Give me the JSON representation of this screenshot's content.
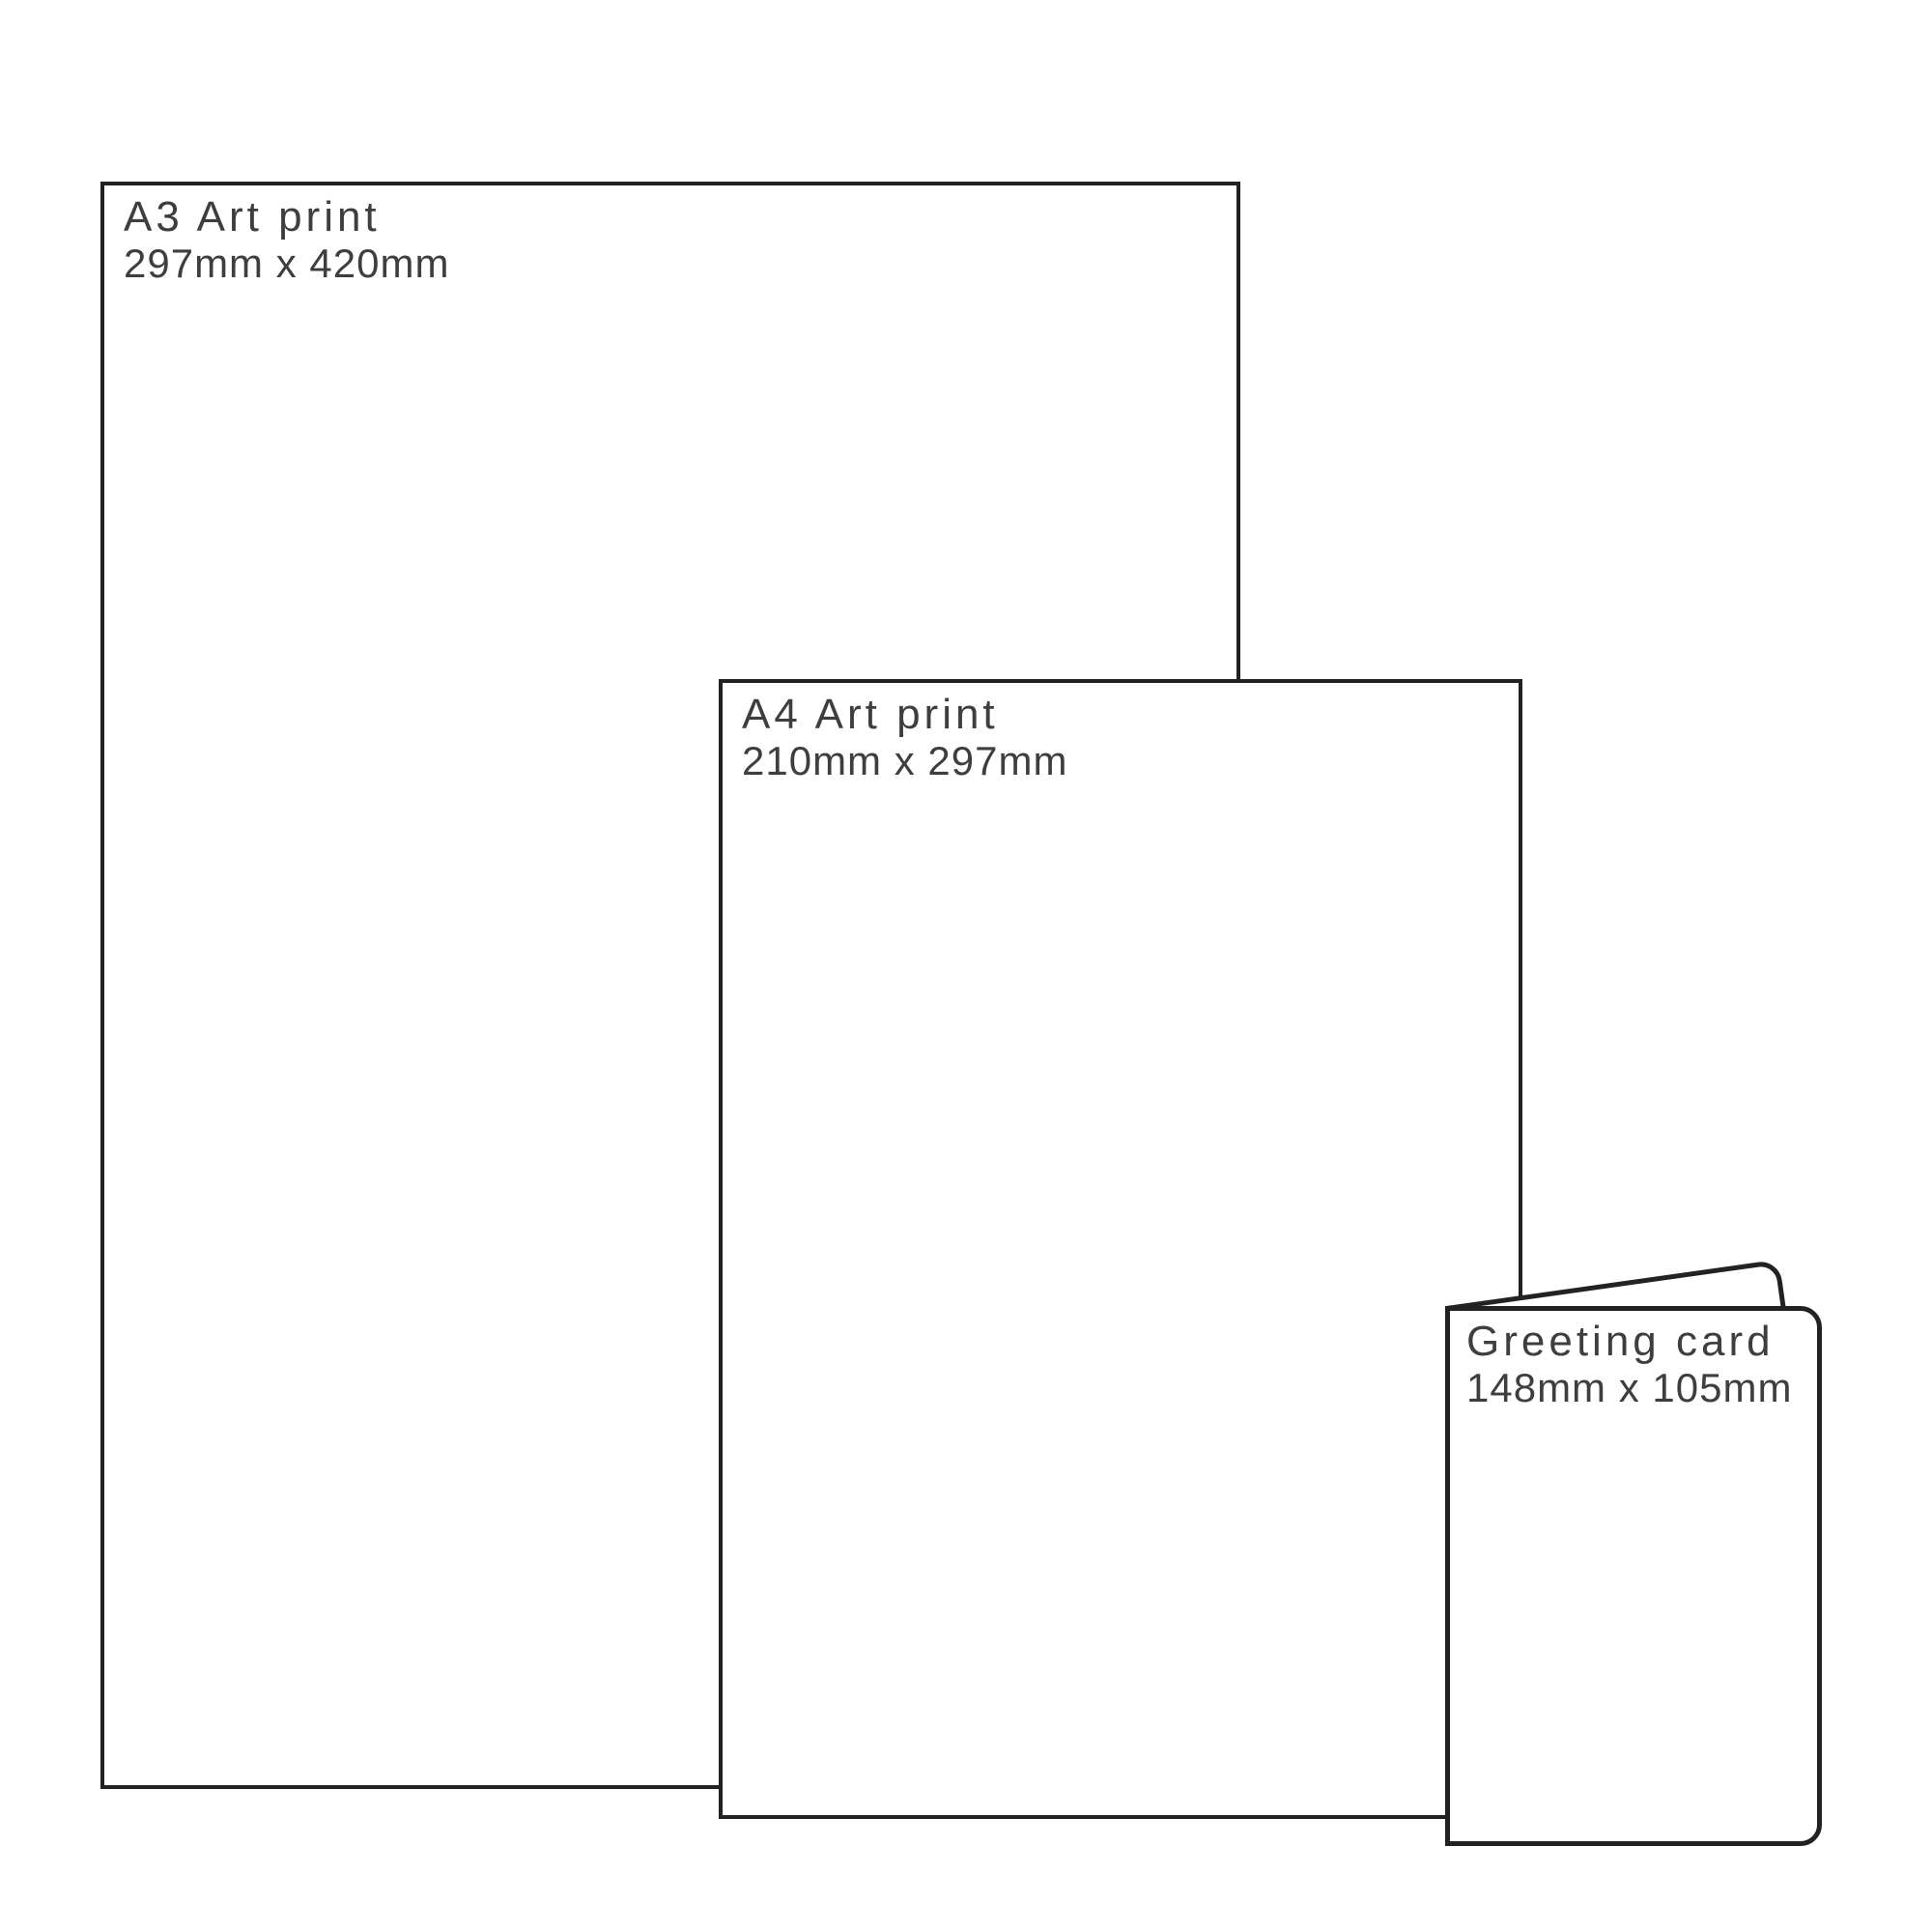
{
  "colors": {
    "background": "#ffffff",
    "outline": "#222222",
    "text": "#3e3e3e"
  },
  "items": [
    {
      "title": "A3 Art print",
      "dimensions": "297mm x 420mm"
    },
    {
      "title": "A4 Art print",
      "dimensions": "210mm x 297mm"
    },
    {
      "title": "Greeting card",
      "dimensions": "148mm x 105mm"
    }
  ]
}
